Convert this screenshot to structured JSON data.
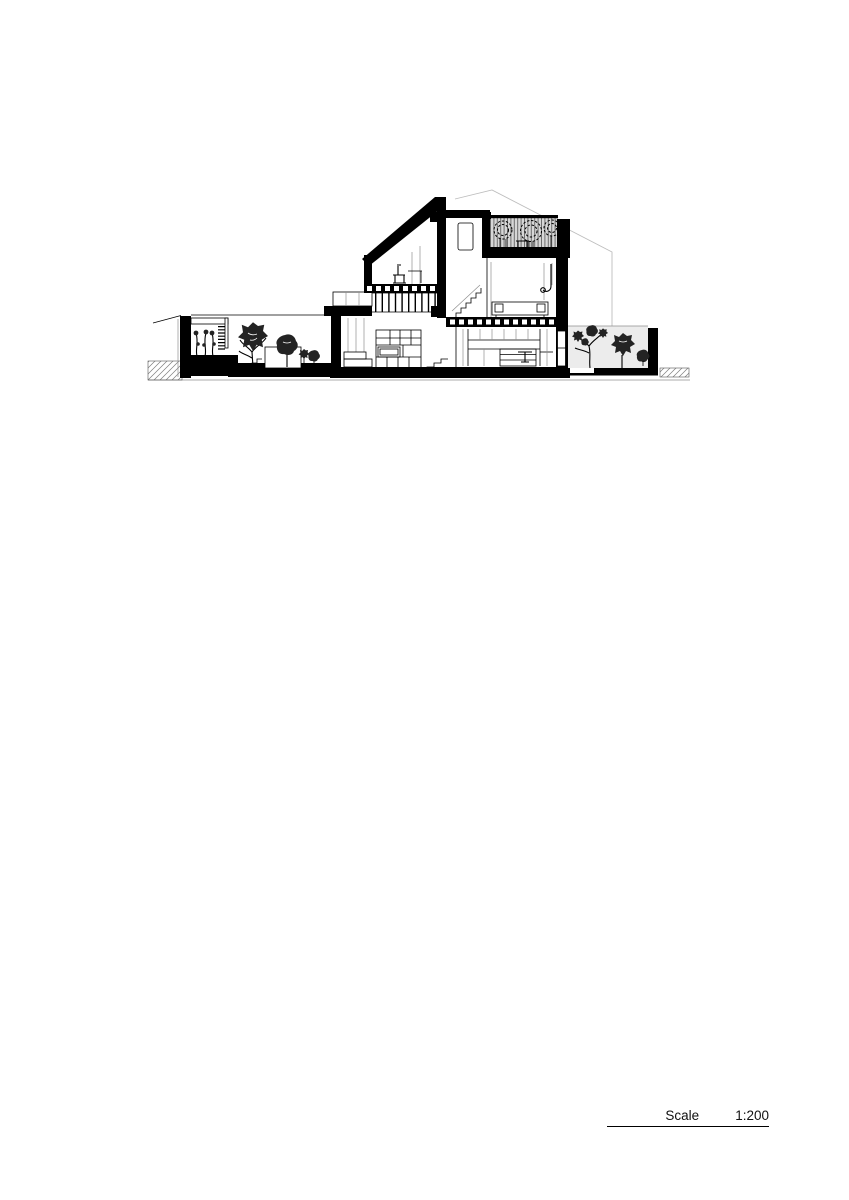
{
  "scale_bar": {
    "label": "Scale",
    "value": "1:200"
  },
  "colors": {
    "ink": "#000000",
    "line_gray": "#8f8f8f",
    "ghost_gray": "#bdbdbd",
    "screen_fill": "#d7d7d7",
    "screen_line": "#6e6e6e",
    "garden_fill": "#ececec",
    "foliage": "#232323",
    "paper": "#ffffff"
  }
}
